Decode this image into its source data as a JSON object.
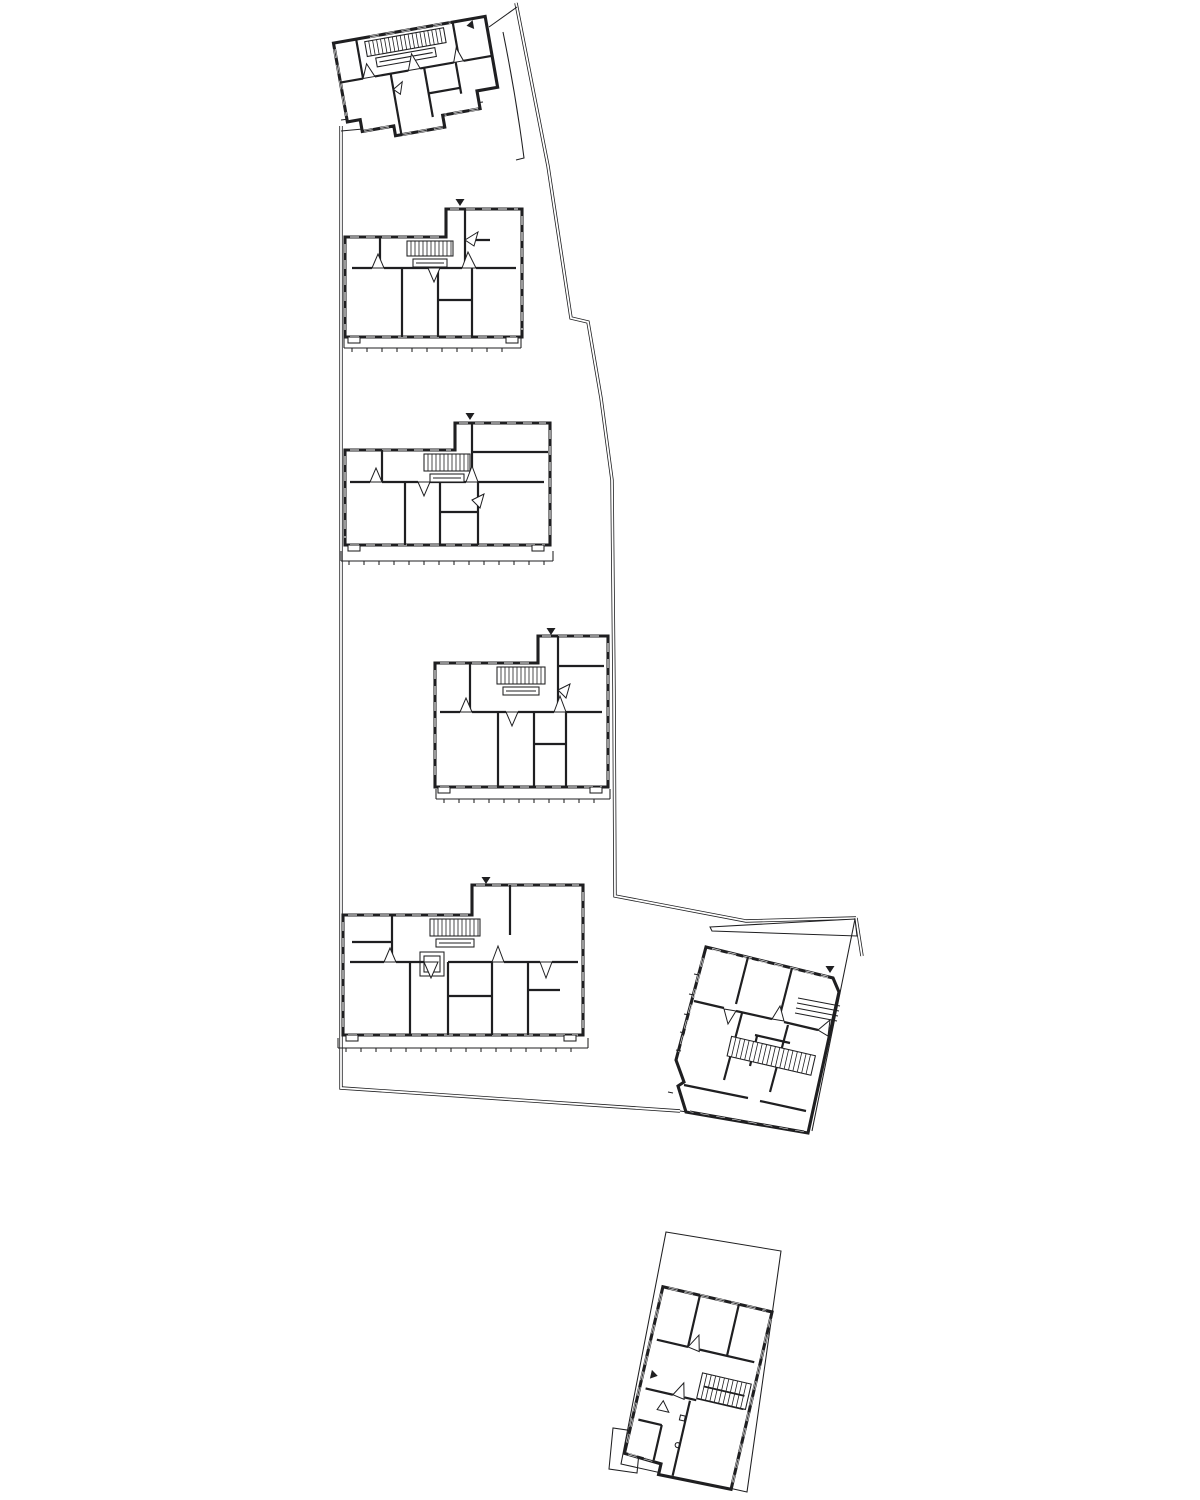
{
  "meta": {
    "title": "architectural-site-floor-plan",
    "width": 1200,
    "height": 1500
  },
  "palette": {
    "ink": "#1f1f21",
    "paper": "#ffffff",
    "soft": "#9a9a9a"
  },
  "stroke": {
    "outer": 3.1,
    "wall": 2.2,
    "thin": 1.05,
    "hatch": 0.8,
    "boundary": 3.4,
    "boundaryGap": 1.8,
    "win": 2.0
  },
  "boundary": {
    "double_paths": [
      "M516 3 L548 166 L571 318 L588 322 L601 398 L612 480 L614 690 L615 896 L746 921 L856 918",
      "M341 126 L341 1088 L680 1111",
      "M856 918 L862 956"
    ],
    "single_paths": [
      "M489 27 L517 7",
      "M503 32 Q516 96 524 158 L516 160",
      "M855 919 L812 1131",
      "M680 1111 L702 1114"
    ],
    "wedge_polys": [
      "M710 927 L855 919 L857 936 L712 931 Z"
    ]
  },
  "parcels": [
    {
      "id": "parcel-south",
      "outline": "M666 1232 L781 1251 L747 1492 L621 1464 Z"
    },
    {
      "id": "parcel-south-tab",
      "outline": "M609 1469 L613 1428 L641 1432 L637 1473 Z"
    }
  ],
  "terraces": [
    {
      "id": "terrace-1",
      "line": [
        341,
        120,
        483,
        102
      ],
      "extra": [
        341,
        131,
        407,
        125
      ],
      "ends": false
    },
    {
      "id": "terrace-2",
      "line": [
        344,
        348,
        521,
        348
      ],
      "ends": true
    },
    {
      "id": "terrace-3",
      "line": [
        341,
        561,
        553,
        561
      ],
      "ends": true
    },
    {
      "id": "terrace-4",
      "line": [
        436,
        799,
        610,
        799
      ],
      "ends": true
    },
    {
      "id": "terrace-5",
      "line": [
        338,
        1048,
        588,
        1048
      ],
      "ends": true
    }
  ],
  "buildings": [
    {
      "id": "building-block-1",
      "tx": 418,
      "ty": 79,
      "rot": -10,
      "outline": "M -77 -50 L 77 -50 L 77 22 L 56 22 L 56 40 L 18 40 L 18 52 L -32 52 L -32 42 L -64 42 L -64 30 L -77 30 Z",
      "window_edges": [
        "M -40 -50 L 42 -50",
        "M -62 42 L -34 42",
        "M 16 52 L -30 52",
        "M 54 40 L 20 40",
        "M -77 -44 L -77 24"
      ],
      "stairs": [
        {
          "x": -46,
          "y": -46,
          "w": 80,
          "h": 15,
          "step": 4,
          "rail": {
            "x": -38,
            "y": -28,
            "w": 60,
            "h": 9
          }
        }
      ],
      "walls": [
        [
          -77,
          -10,
          -54,
          -10
        ],
        [
          -42,
          -10,
          -8,
          -10
        ],
        [
          4,
          -10,
          38,
          -10
        ],
        [
          48,
          -10,
          77,
          -10
        ],
        [
          -54,
          -50,
          -54,
          -10
        ],
        [
          44,
          -50,
          44,
          -10
        ],
        [
          -26,
          -10,
          -26,
          52
        ],
        [
          8,
          -10,
          8,
          40
        ],
        [
          40,
          -10,
          40,
          22
        ],
        [
          8,
          16,
          40,
          16
        ]
      ],
      "wedges": [
        "M -54 -10 L -48 -24 L -42 -10 Z",
        "M -8 -10 L -2 -26 L 4 -10 Z",
        "M 38 -10 L 43 -24 L 48 -10 Z",
        "M -26 6 L -16 0 L -20 12 Z"
      ],
      "marker": {
        "x": 64,
        "y": -44,
        "dir": "left"
      }
    },
    {
      "id": "building-block-2",
      "tx": 0,
      "ty": 0,
      "rot": 0,
      "outline": "M345 237 L446 237 L446 209 L522 209 L522 337 L345 337 Z",
      "window_edges": [
        "M350 337 L516 337",
        "M350 237 L442 237",
        "M450 209 L518 209",
        "M345 244 L345 330",
        "M522 216 L522 330"
      ],
      "stairs": [
        {
          "x": 407,
          "y": 241,
          "w": 46,
          "h": 15,
          "step": 4,
          "rail": {
            "x": 413,
            "y": 259,
            "w": 34,
            "h": 8
          }
        }
      ],
      "walls": [
        [
          380,
          237,
          380,
          268
        ],
        [
          465,
          209,
          465,
          268
        ],
        [
          352,
          268,
          372,
          268
        ],
        [
          384,
          268,
          428,
          268
        ],
        [
          440,
          268,
          462,
          268
        ],
        [
          476,
          268,
          516,
          268
        ],
        [
          402,
          268,
          402,
          337
        ],
        [
          438,
          268,
          438,
          337
        ],
        [
          472,
          268,
          472,
          337
        ],
        [
          438,
          300,
          472,
          300
        ],
        [
          465,
          240,
          490,
          240
        ]
      ],
      "wedges": [
        "M372 268 L378 254 L384 268 Z",
        "M428 268 L434 282 L440 268 Z",
        "M462 268 L468 252 L476 268 Z",
        "M465 240 L478 232 L474 246 Z"
      ],
      "balconies": [
        [
          348,
          337,
          12,
          6
        ],
        [
          506,
          337,
          12,
          6
        ]
      ],
      "marker": {
        "x": 460,
        "y": 199,
        "dir": "down"
      }
    },
    {
      "id": "building-block-3",
      "tx": 0,
      "ty": 0,
      "rot": 0,
      "outline": "M345 450 L455 450 L455 423 L550 423 L550 545 L345 545 Z",
      "window_edges": [
        "M350 545 L545 545",
        "M350 450 L451 450",
        "M459 423 L546 423",
        "M345 456 L345 538",
        "M550 430 L550 538"
      ],
      "stairs": [
        {
          "x": 424,
          "y": 454,
          "w": 46,
          "h": 17,
          "step": 4,
          "rail": {
            "x": 430,
            "y": 474,
            "w": 34,
            "h": 8
          }
        }
      ],
      "walls": [
        [
          382,
          450,
          382,
          482
        ],
        [
          472,
          423,
          472,
          482
        ],
        [
          350,
          482,
          370,
          482
        ],
        [
          382,
          482,
          418,
          482
        ],
        [
          430,
          482,
          466,
          482
        ],
        [
          478,
          482,
          544,
          482
        ],
        [
          405,
          482,
          405,
          545
        ],
        [
          440,
          482,
          440,
          545
        ],
        [
          478,
          482,
          478,
          545
        ],
        [
          440,
          512,
          478,
          512
        ],
        [
          472,
          452,
          548,
          452
        ]
      ],
      "wedges": [
        "M370 482 L376 468 L382 482 Z",
        "M418 482 L424 496 L430 482 Z",
        "M466 482 L472 466 L478 482 Z",
        "M472 500 L484 494 L480 508 Z"
      ],
      "balconies": [
        [
          348,
          545,
          12,
          6
        ],
        [
          532,
          545,
          12,
          6
        ]
      ],
      "marker": {
        "x": 470,
        "y": 413,
        "dir": "down"
      }
    },
    {
      "id": "building-block-4",
      "tx": 0,
      "ty": 0,
      "rot": 0,
      "outline": "M435 663 L538 663 L538 636 L608 636 L608 787 L435 787 Z",
      "window_edges": [
        "M440 787 L602 787",
        "M440 663 L534 663",
        "M542 636 L604 636",
        "M435 670 L435 780",
        "M608 643 L608 780"
      ],
      "stairs": [
        {
          "x": 497,
          "y": 667,
          "w": 48,
          "h": 17,
          "step": 4,
          "rail": {
            "x": 503,
            "y": 687,
            "w": 36,
            "h": 8
          }
        }
      ],
      "walls": [
        [
          470,
          663,
          470,
          712
        ],
        [
          558,
          636,
          558,
          712
        ],
        [
          440,
          712,
          460,
          712
        ],
        [
          472,
          712,
          506,
          712
        ],
        [
          518,
          712,
          554,
          712
        ],
        [
          566,
          712,
          602,
          712
        ],
        [
          498,
          712,
          498,
          787
        ],
        [
          534,
          712,
          534,
          787
        ],
        [
          566,
          712,
          566,
          787
        ],
        [
          534,
          744,
          566,
          744
        ],
        [
          558,
          666,
          604,
          666
        ]
      ],
      "wedges": [
        "M460 712 L466 698 L472 712 Z",
        "M506 712 L512 726 L518 712 Z",
        "M554 712 L560 696 L566 712 Z",
        "M558 690 L570 684 L566 698 Z"
      ],
      "balconies": [
        [
          438,
          787,
          12,
          6
        ],
        [
          590,
          787,
          12,
          6
        ]
      ],
      "marker": {
        "x": 551,
        "y": 628,
        "dir": "down"
      }
    },
    {
      "id": "building-block-5",
      "tx": 0,
      "ty": 0,
      "rot": 0,
      "outline": "M343 915 L472 915 L472 885 L583 885 L583 1035 L343 1035 Z",
      "window_edges": [
        "M348 1035 L578 1035",
        "M348 915 L468 915",
        "M476 885 L579 885",
        "M343 922 L343 1028",
        "M583 892 L583 1028"
      ],
      "stairs": [
        {
          "x": 430,
          "y": 919,
          "w": 50,
          "h": 17,
          "step": 4,
          "rail": {
            "x": 436,
            "y": 939,
            "w": 38,
            "h": 8
          }
        }
      ],
      "thin_rects": [
        [
          420,
          952,
          24,
          24
        ],
        [
          424,
          956,
          16,
          16
        ]
      ],
      "walls": [
        [
          392,
          915,
          392,
          962
        ],
        [
          510,
          885,
          510,
          935
        ],
        [
          350,
          962,
          384,
          962
        ],
        [
          396,
          962,
          424,
          962
        ],
        [
          448,
          962,
          492,
          962
        ],
        [
          504,
          962,
          540,
          962
        ],
        [
          552,
          962,
          578,
          962
        ],
        [
          410,
          962,
          410,
          1035
        ],
        [
          448,
          962,
          448,
          1035
        ],
        [
          492,
          962,
          492,
          1035
        ],
        [
          528,
          962,
          528,
          1035
        ],
        [
          448,
          996,
          492,
          996
        ],
        [
          352,
          942,
          392,
          942
        ],
        [
          528,
          990,
          560,
          990
        ]
      ],
      "wedges": [
        "M384 962 L390 948 L396 962 Z",
        "M424 962 L431 978 L438 962 Z",
        "M492 962 L498 946 L504 962 Z",
        "M540 962 L546 978 L552 962 Z"
      ],
      "balconies": [
        [
          346,
          1035,
          12,
          6
        ],
        [
          564,
          1035,
          12,
          6
        ]
      ],
      "marker": {
        "x": 486,
        "y": 877,
        "dir": "down"
      }
    },
    {
      "id": "building-block-6",
      "tx": 0,
      "ty": 0,
      "rot": 0,
      "outline": "M706 947 L833 978 L839 992 L808 1133 L686 1112 L678 1086 L684 1082 L676 1060 Z",
      "window_edges": [
        "M712 949 L828 977",
        "M804 1131 L690 1111",
        "M703 958 L679 1052"
      ],
      "stairs": [
        {
          "tx": 772,
          "ty": 1057,
          "rot": 13,
          "x": -44,
          "y": -11,
          "w": 86,
          "h": 20,
          "step": 4.5
        }
      ],
      "walls": [
        [
          748,
          957,
          736,
          1004
        ],
        [
          792,
          968,
          780,
          1015
        ],
        [
          694,
          1001,
          724,
          1008
        ],
        [
          736,
          1011,
          772,
          1019
        ],
        [
          784,
          1022,
          818,
          1030
        ],
        [
          742,
          1013,
          724,
          1080
        ],
        [
          788,
          1025,
          770,
          1092
        ],
        [
          684,
          1085,
          748,
          1098
        ],
        [
          760,
          1101,
          806,
          1111
        ],
        [
          755,
          1035,
          790,
          1043
        ],
        [
          757,
          1036,
          750,
          1066
        ]
      ],
      "thin": [
        [
          798,
          998,
          840,
          1006
        ],
        [
          797,
          1003,
          839,
          1011
        ],
        [
          796,
          1008,
          838,
          1016
        ],
        [
          795,
          1013,
          837,
          1021
        ],
        [
          699,
          975,
          694,
          974
        ],
        [
          694,
          995,
          689,
          994
        ],
        [
          689,
          1015,
          684,
          1014
        ],
        [
          685,
          1033,
          680,
          1032
        ],
        [
          681,
          1051,
          676,
          1050
        ],
        [
          673,
          1093,
          668,
          1092
        ]
      ],
      "wedges": [
        "M772 1019 L780 1006 L784 1021 Z",
        "M736 1011 L728 1024 L724 1009 Z",
        "M818 1030 L830 1020 L828 1036 Z"
      ],
      "marker": {
        "x": 830,
        "y": 966,
        "dir": "down"
      }
    },
    {
      "id": "building-block-7",
      "tx": 697,
      "ty": 1388,
      "rot": 13,
      "outline": "M -56 -91 L 56 -91 L 56 91 L -18 93 L -18 82 L -56 80 Z",
      "window_edges": [
        "M -50 -91 L 50 -91",
        "M -52 80 L -20 81",
        "M 56 -84 L 56 84",
        "M -56 -84 L -56 74"
      ],
      "stairs": [
        {
          "x": 2,
          "y": -16,
          "w": 50,
          "h": 26,
          "step": 4.5,
          "divider": true
        }
      ],
      "walls": [
        [
          -50,
          -38,
          -18,
          -38
        ],
        [
          -6,
          -38,
          50,
          -38
        ],
        [
          -18,
          -91,
          -18,
          -38
        ],
        [
          22,
          -91,
          22,
          -38
        ],
        [
          -50,
          12,
          -22,
          12
        ],
        [
          -10,
          12,
          2,
          12
        ],
        [
          -4,
          14,
          -4,
          91
        ],
        [
          -50,
          44,
          -26,
          44
        ],
        [
          -26,
          44,
          -26,
          80
        ],
        [
          2,
          10,
          50,
          10
        ]
      ],
      "wedges": [
        "M -18 -38 L -10 -52 L -6 -36 Z",
        "M -22 12 L -14 -2 L -10 14 Z",
        "M -30 20 L -22 30 L -34 30 Z"
      ],
      "dots": [
        [
          -6,
          60
        ]
      ],
      "squares": [
        [
          -10,
          30,
          5,
          5
        ]
      ],
      "marker": {
        "x": -48,
        "y": -3,
        "dir": "right"
      }
    }
  ]
}
